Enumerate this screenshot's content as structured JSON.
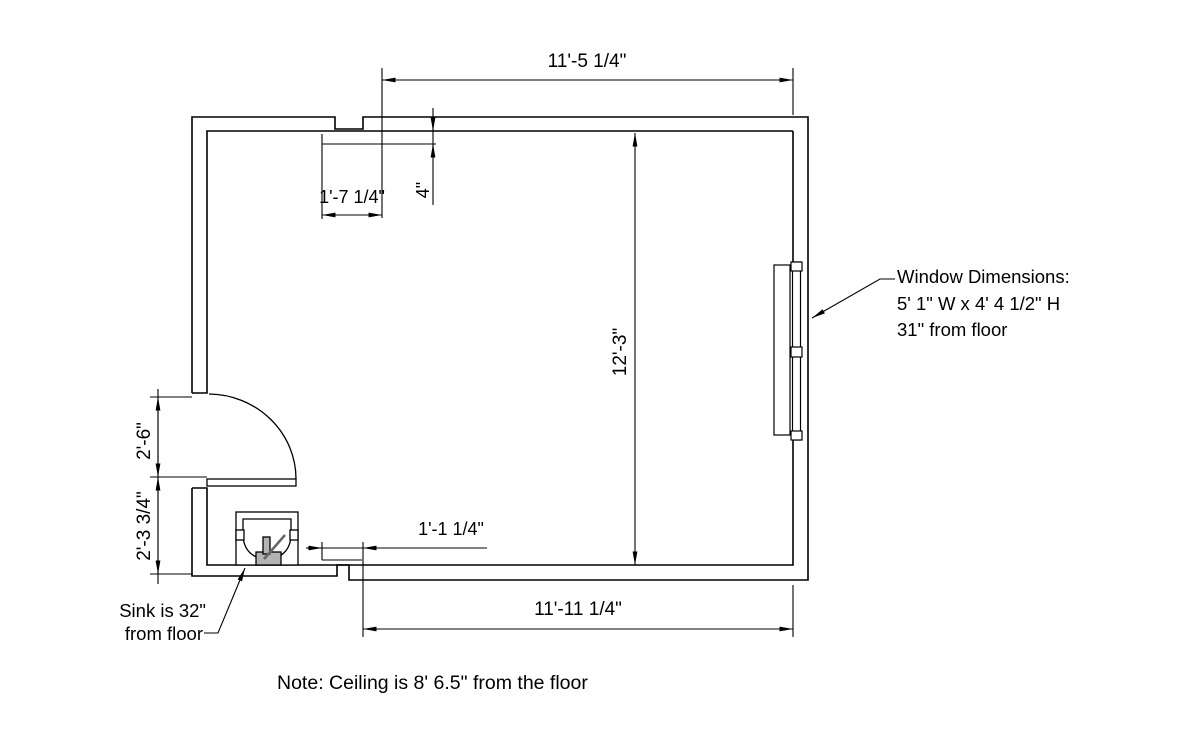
{
  "drawing": {
    "colors": {
      "line": "#000000",
      "background": "#ffffff",
      "fixture_fill": "#b3b3b3"
    },
    "dimensions": {
      "top_width": "11'-5 1/4\"",
      "alcove_width": "1'-7 1/4\"",
      "alcove_depth": "4\"",
      "room_depth": "12'-3\"",
      "door_opening": "2'-6\"",
      "door_to_wall": "2'-3 3/4\"",
      "sink_to_wall": "1'-1 1/4\"",
      "bottom_width": "11'-11 1/4\""
    },
    "annotations": {
      "window": {
        "line1": "Window Dimensions:",
        "line2": "5' 1\" W x 4' 4 1/2\" H",
        "line3": "31\" from floor"
      },
      "sink": {
        "line1": "Sink is 32\"",
        "line2": "from floor"
      },
      "note": "Note: Ceiling is 8' 6.5\" from the floor"
    }
  }
}
